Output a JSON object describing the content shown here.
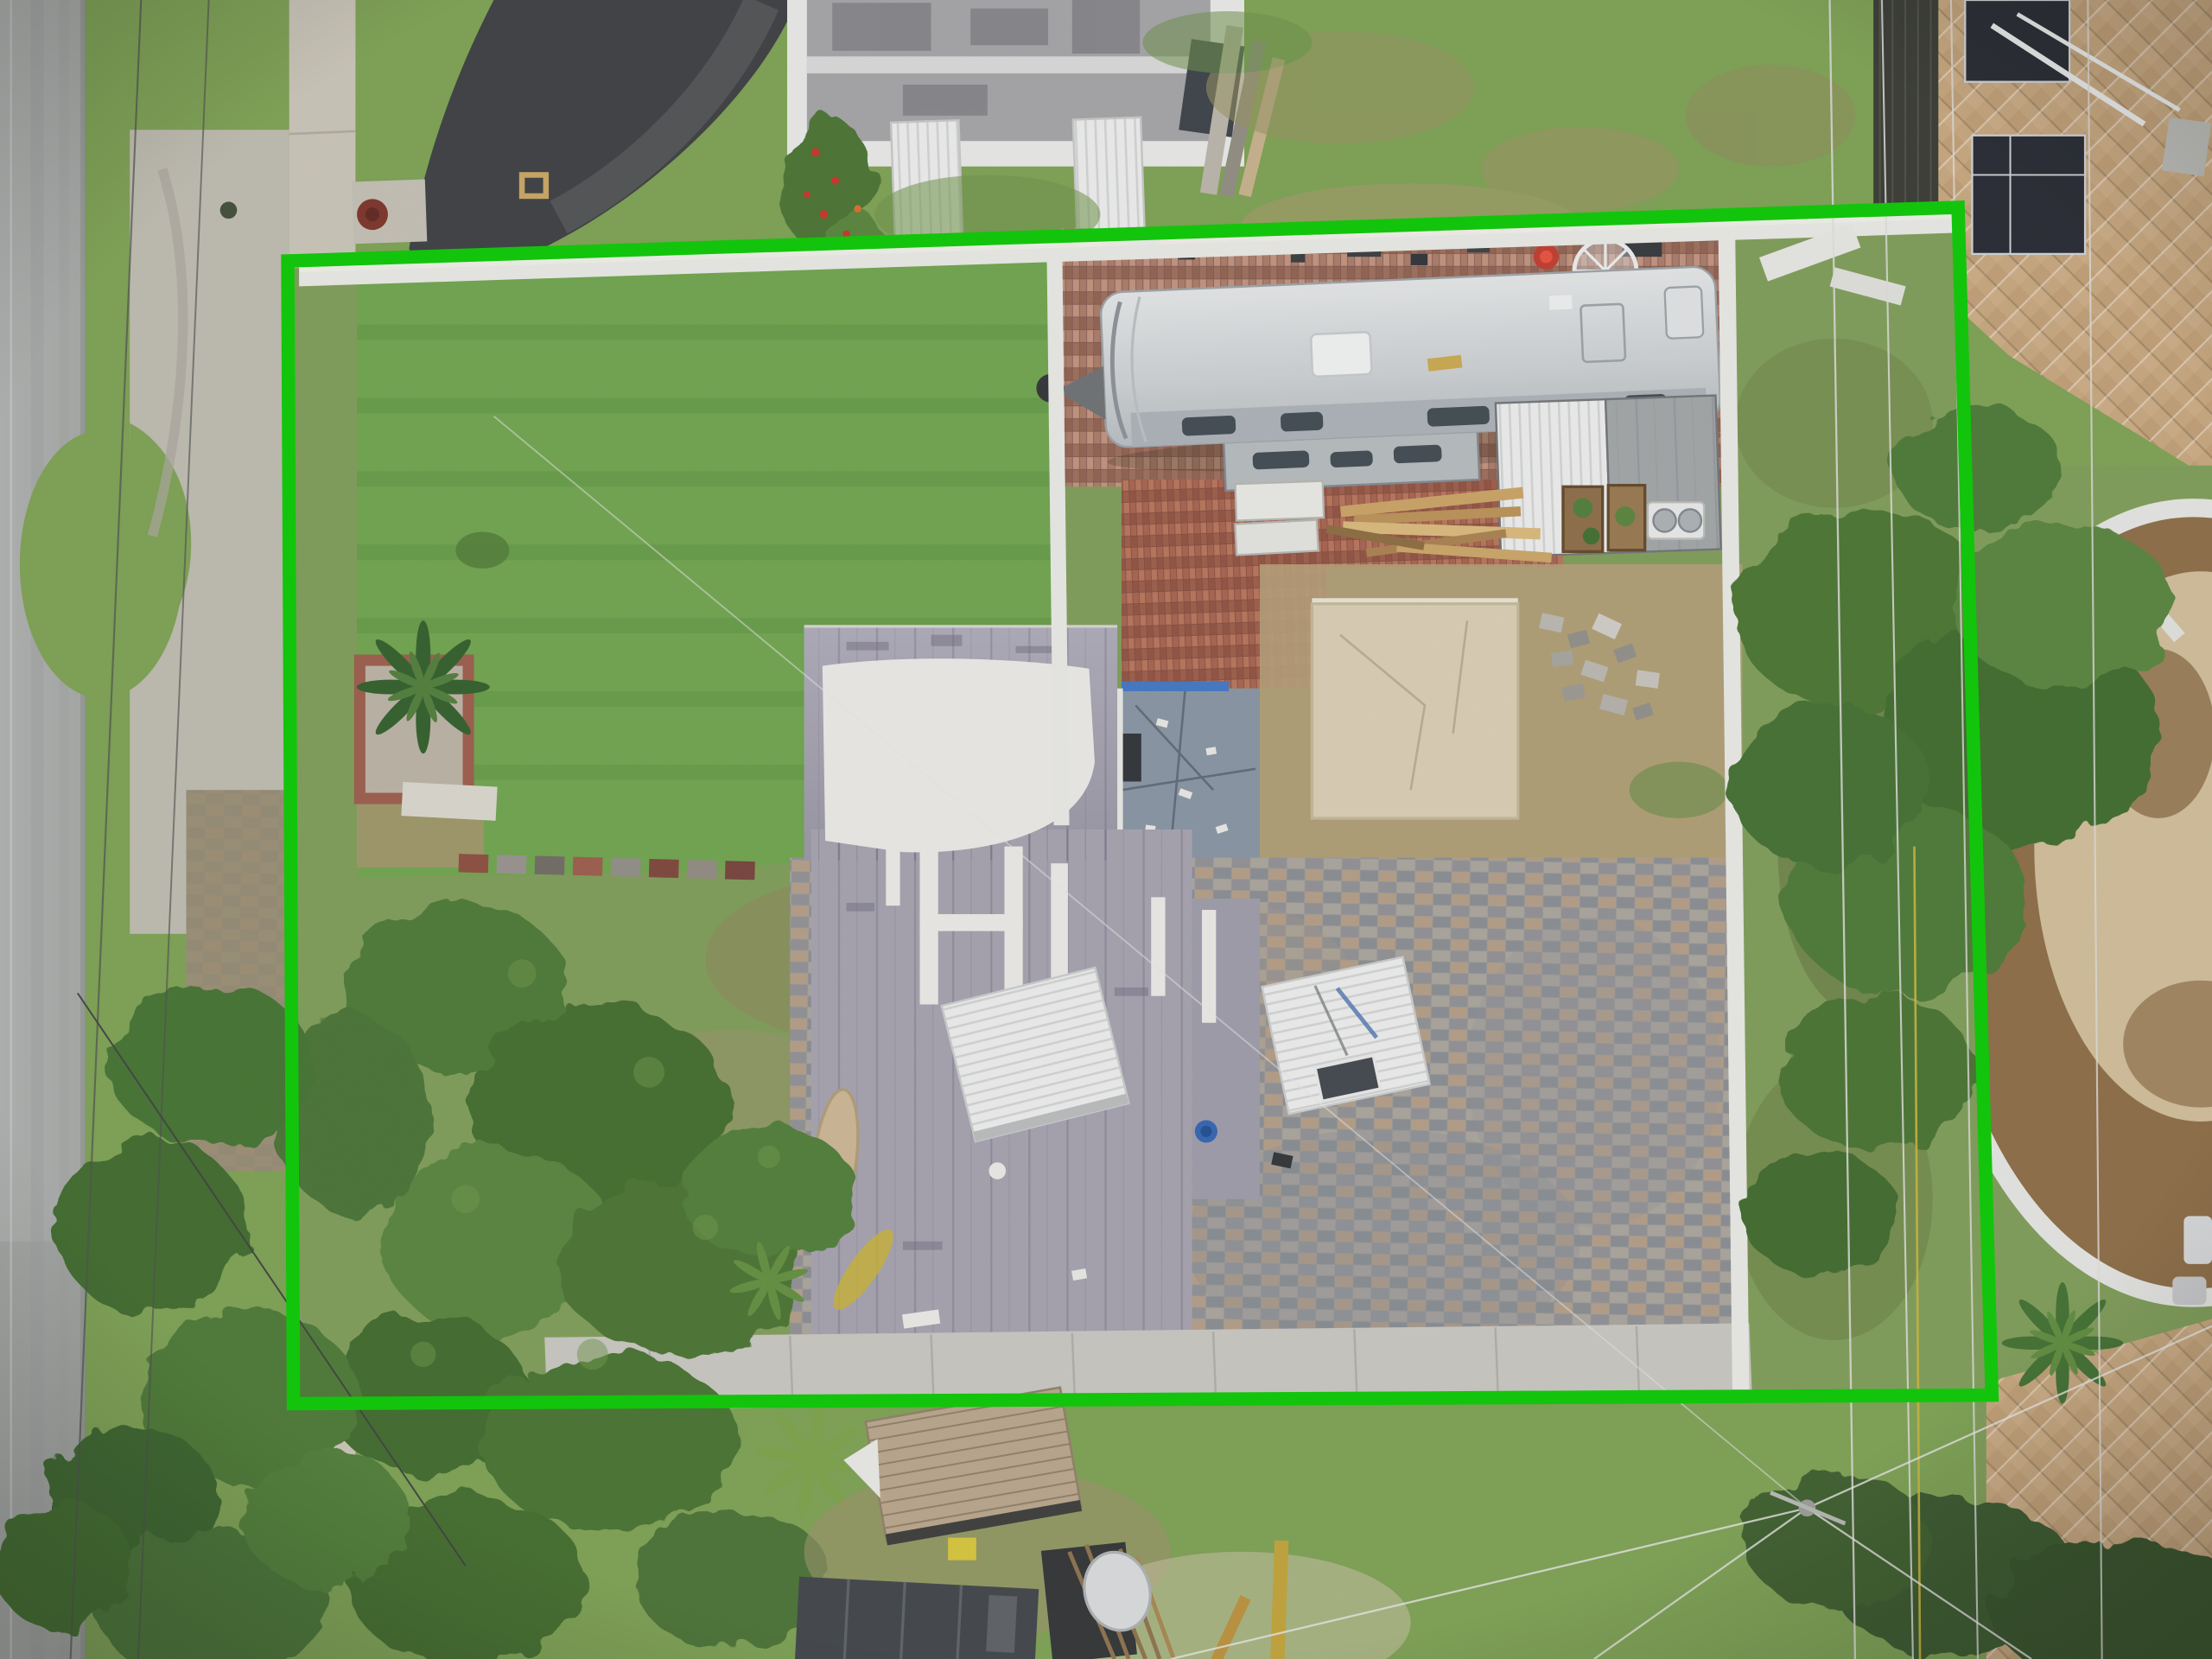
{
  "image": {
    "kind": "aerial-drone-photograph",
    "view": "top-down residential lot"
  },
  "annotation": {
    "shape": "property-boundary-rectangle",
    "label": "highlighted lot outline"
  },
  "colors": {
    "boundary_green": "#13c40c",
    "road_gray": "#a8aba9",
    "sidewalk_concrete": "#c9c3b6",
    "apron_concrete": "#bdb9ae",
    "verge_grass": "#7b9f50",
    "lawn_green": "#6ca24a",
    "scrub_grass": "#7d9b55",
    "driveway_asphalt": "#3a3c3f",
    "house_roof_gray": "#a3a0ae",
    "roof_paint_white": "#eceae6",
    "rv_body": "#d3d6d8",
    "shed_roof": "#c3c5c7",
    "brick_patio": "#a97f6b",
    "slate_pavers": "#9a9998",
    "tan_pavers": "#c5a47c",
    "concrete_slab": "#d9cdb2",
    "blue_patio": "#8593a0",
    "mulch_bed": "#8a6a43",
    "sand_patch": "#d5c3a0",
    "tree_canopy": "#4a7733",
    "white_fence": "#e9e9e5",
    "deck_wood": "#b7a489",
    "dark_shed": "#3e4246"
  },
  "objects": [
    "asphalt-road",
    "concrete-sidewalk",
    "grass-verge",
    "curved-asphalt-driveway",
    "neighbor-mobile-home",
    "front-lawn",
    "white-vinyl-fence",
    "travel-trailer-rv",
    "brick-paver-patio",
    "storage-shed",
    "lumber-pile",
    "concrete-slab",
    "blue-gray-patio",
    "main-house-gray-roof-with-white-paint",
    "slate-paver-backyard",
    "white-carport-roofs",
    "interior-tree-canopy",
    "stepping-stones",
    "mulch-planter-white-wall",
    "palm-trees",
    "tan-paver-driveways",
    "wooden-deck",
    "utility-pole",
    "power-lines"
  ]
}
